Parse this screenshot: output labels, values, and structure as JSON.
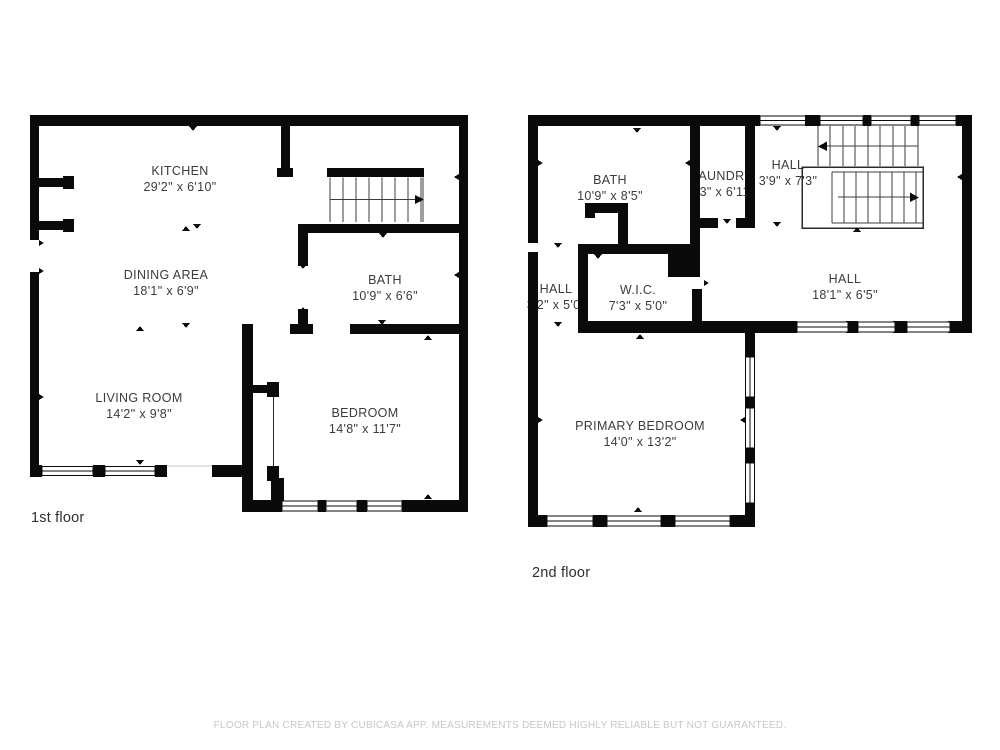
{
  "floors": [
    {
      "label": "1st floor",
      "rooms": [
        {
          "name": "KITCHEN",
          "dims": "29'2\" x 6'10\""
        },
        {
          "name": "DINING AREA",
          "dims": "18'1\" x 6'9\""
        },
        {
          "name": "BATH",
          "dims": "10'9\" x 6'6\""
        },
        {
          "name": "LIVING ROOM",
          "dims": "14'2\" x 9'8\""
        },
        {
          "name": "BEDROOM",
          "dims": "14'8\" x 11'7\""
        }
      ]
    },
    {
      "label": "2nd floor",
      "rooms": [
        {
          "name": "BATH",
          "dims": "10'9\" x 8'5\""
        },
        {
          "name": "LAUNDRY",
          "dims": "3'3\" x 6'11\""
        },
        {
          "name": "HALL",
          "dims": "3'9\" x 7'3\""
        },
        {
          "name": "HALL",
          "dims": "18'1\" x 6'5\""
        },
        {
          "name": "HALL",
          "dims": "3'2\" x 5'0\""
        },
        {
          "name": "W.I.C.",
          "dims": "7'3\" x 5'0\""
        },
        {
          "name": "PRIMARY BEDROOM",
          "dims": "14'0\" x 13'2\""
        }
      ]
    }
  ],
  "footer": {
    "disclaimer": "FLOOR PLAN CREATED BY CUBICASA APP. MEASUREMENTS DEEMED HIGHLY RELIABLE BUT NOT GUARANTEED."
  },
  "colors": {
    "wall": "#0a0a0a",
    "room_text": "#3b3b3b",
    "muted_text": "#c7c7c7"
  }
}
